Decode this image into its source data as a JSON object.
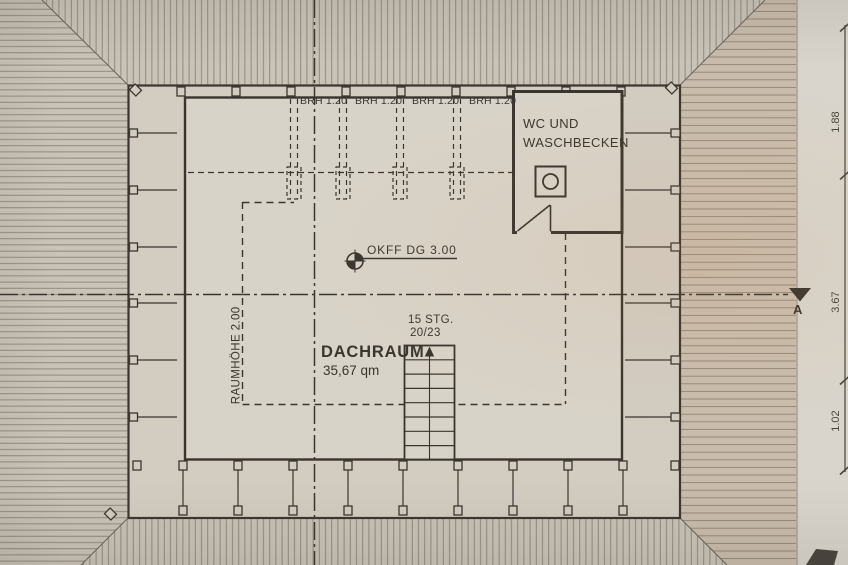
{
  "plan": {
    "room": {
      "name": "DACHRAUM",
      "area": "35,67 qm"
    },
    "wc_room": {
      "label_line1": "WC UND",
      "label_line2": "WASCHBECKEN"
    },
    "windows": [
      {
        "label": "BRH 1.20"
      },
      {
        "label": "BRH 1.20"
      },
      {
        "label": "BRH 1.20"
      },
      {
        "label": "BRH 1.20"
      }
    ],
    "level_marker": {
      "label": "OKFF DG 3.00"
    },
    "stairs": {
      "line1": "15 STG.",
      "line2": "20/23"
    },
    "room_height_note": "RAUMHÖHE 2.00",
    "section_marker": "A",
    "dimensions": [
      {
        "value": "1.88"
      },
      {
        "value": "3.67"
      },
      {
        "value": "1.02"
      }
    ]
  },
  "colors": {
    "paper_main": "#cdc7bc",
    "paper_right": "#d9d5cc",
    "roof_bg": "#cac3b8",
    "band_bg": "#d2ccc1",
    "room_bg": "#d8d3c8",
    "hatch_line": "#8a8376",
    "hip_line": "#6e675c",
    "ink": "#3a362f",
    "dim_ink": "#4a453d"
  }
}
